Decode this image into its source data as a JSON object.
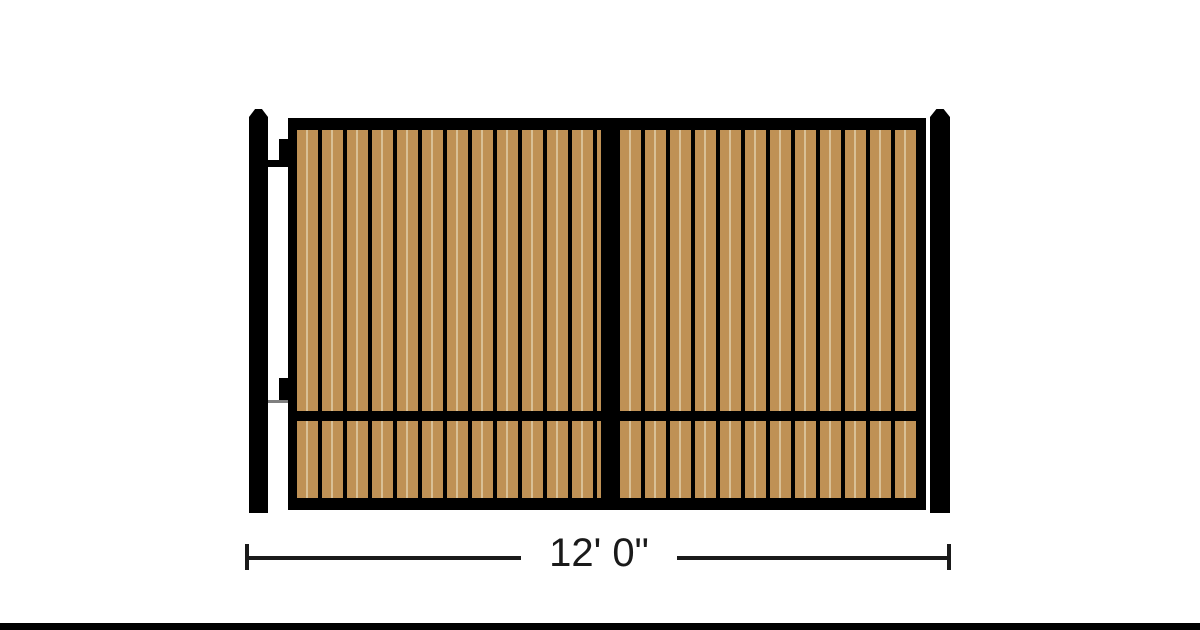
{
  "diagram": {
    "dimension": {
      "label": "12' 0\""
    },
    "structure": {
      "posts": 2,
      "gate_leaves": 2,
      "hinges_visible": 2,
      "infill_style": "vertical wood slats",
      "rails": [
        "top",
        "middle",
        "bottom"
      ]
    },
    "colors": {
      "background": "#ffffff",
      "frame": "#000000",
      "wood": "#bf9155",
      "wood_highlight": "#d9c096",
      "hinge_arm": "#7f7f7f",
      "dimension": "#1a1a1a",
      "footer_bar": "#000000"
    }
  }
}
